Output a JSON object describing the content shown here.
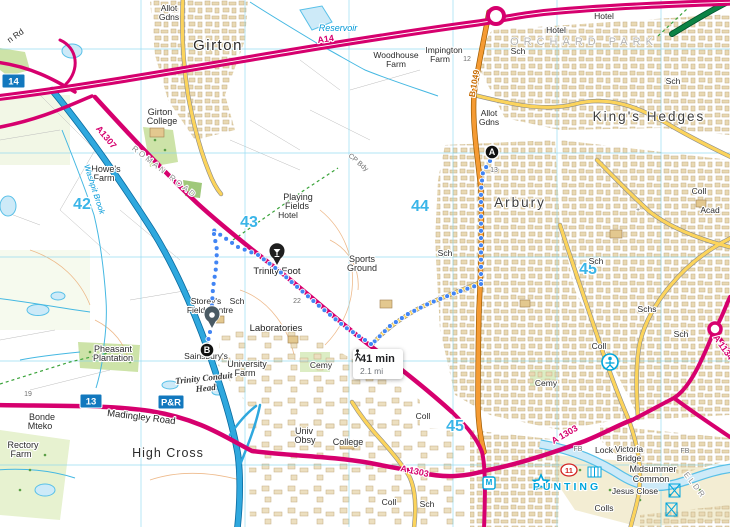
{
  "map": {
    "region": "Cambridge north-west: Girton, Arbury, King's Hedges, High Cross",
    "tooltip": {
      "duration": "41 min",
      "distance": "2.1 mi",
      "mode": "walking"
    },
    "colors": {
      "route_dot": "#4285f4",
      "motorway": "#2fa8de",
      "a_road": "#d6006e",
      "b_road": "#f59b33",
      "primary_green": "#0c8345",
      "minor_road": "#fcd45c",
      "water": "#cdeaf8",
      "grid": "#7fd4f0",
      "urban": "#e9d9b4"
    },
    "route": {
      "segments": [
        [
          [
            490,
            161
          ],
          [
            483,
            172
          ],
          [
            481,
            190
          ],
          [
            481,
            220
          ],
          [
            481,
            250
          ],
          [
            481,
            282
          ]
        ],
        [
          [
            481,
            284
          ],
          [
            455,
            293
          ],
          [
            430,
            303
          ],
          [
            408,
            314
          ],
          [
            390,
            326
          ],
          [
            373,
            343
          ]
        ],
        [
          [
            371,
            344
          ],
          [
            345,
            327
          ],
          [
            318,
            305
          ],
          [
            295,
            285
          ],
          [
            278,
            270
          ],
          [
            258,
            255
          ],
          [
            238,
            247
          ],
          [
            222,
            236
          ],
          [
            212,
            229
          ]
        ],
        [
          [
            214,
            234
          ],
          [
            217,
            250
          ],
          [
            216,
            268
          ],
          [
            213,
            288
          ],
          [
            212,
            305
          ],
          [
            211,
            316
          ]
        ],
        [
          [
            210,
            332
          ],
          [
            208,
            341
          ],
          [
            207,
            347
          ]
        ]
      ],
      "markers": [
        {
          "label": "A",
          "x": 492,
          "y": 152
        },
        {
          "label": "B",
          "x": 207,
          "y": 350
        }
      ],
      "pins": [
        {
          "name": "trinity-foot-pin",
          "x": 277,
          "y": 266,
          "color": "#1f1f1f",
          "glyph": "glass"
        },
        {
          "name": "storey-field-centre-pin",
          "x": 212,
          "y": 329,
          "color": "#4a5a63",
          "glyph": "dot"
        }
      ]
    },
    "badges": [
      {
        "t": "14",
        "x": 2,
        "y": 74,
        "w": 23,
        "h": 14,
        "type": "motorway-junction"
      },
      {
        "t": "13",
        "x": 80,
        "y": 394,
        "w": 22,
        "h": 14,
        "type": "motorway-junction"
      },
      {
        "t": "P&R",
        "x": 158,
        "y": 395,
        "w": 26,
        "h": 14,
        "type": "park-and-ride"
      }
    ],
    "labels": [
      {
        "t": "Girton",
        "x": 218,
        "y": 50,
        "cls": "big"
      },
      {
        "t": "n Rd",
        "x": 17,
        "y": 38,
        "cls": "sm",
        "r": -35
      },
      {
        "t": "Allot",
        "x": 169,
        "y": 11,
        "cls": "sm"
      },
      {
        "t": "Gdns",
        "x": 169,
        "y": 20,
        "cls": "sm"
      },
      {
        "t": "Reservoir",
        "x": 338,
        "y": 31,
        "cls": "water"
      },
      {
        "t": "A14",
        "x": 326,
        "y": 42,
        "cls": "rpink",
        "r": -8
      },
      {
        "t": "Woodhouse",
        "x": 396,
        "y": 58,
        "cls": "sm"
      },
      {
        "t": "Farm",
        "x": 396,
        "y": 67,
        "cls": "sm"
      },
      {
        "t": "Impington",
        "x": 444,
        "y": 53,
        "cls": "sm"
      },
      {
        "t": "Farm",
        "x": 440,
        "y": 62,
        "cls": "sm"
      },
      {
        "t": "12",
        "x": 467,
        "y": 61,
        "cls": "tiny"
      },
      {
        "t": "B 1049",
        "x": 477,
        "y": 84,
        "cls": "rorange",
        "r": -80
      },
      {
        "t": "Hotel",
        "x": 604,
        "y": 19,
        "cls": "sm"
      },
      {
        "t": "Hotel",
        "x": 556,
        "y": 33,
        "cls": "sm"
      },
      {
        "t": "ORCHARD PARK",
        "x": 584,
        "y": 45,
        "cls": "faint"
      },
      {
        "t": "Sch",
        "x": 518,
        "y": 54,
        "cls": "sm"
      },
      {
        "t": "Sch",
        "x": 673,
        "y": 84,
        "cls": "sm"
      },
      {
        "t": "King's Hedges",
        "x": 649,
        "y": 121,
        "cls": "big2"
      },
      {
        "t": "Allot",
        "x": 489,
        "y": 116,
        "cls": "sm"
      },
      {
        "t": "Gdns",
        "x": 489,
        "y": 125,
        "cls": "sm"
      },
      {
        "t": "Girton",
        "x": 160,
        "y": 115,
        "cls": "sm2"
      },
      {
        "t": "College",
        "x": 162,
        "y": 124,
        "cls": "sm2"
      },
      {
        "t": "A1307",
        "x": 104,
        "y": 139,
        "cls": "rpink",
        "r": 50
      },
      {
        "t": "ROMAN ROAD",
        "x": 163,
        "y": 174,
        "cls": "caps",
        "r": 38
      },
      {
        "t": "Howe's",
        "x": 106,
        "y": 172,
        "cls": "sm2"
      },
      {
        "t": "Farm",
        "x": 104,
        "y": 181,
        "cls": "sm2"
      },
      {
        "t": "Washpit Brook",
        "x": 92,
        "y": 190,
        "cls": "water2",
        "r": 72
      },
      {
        "t": "42",
        "x": 82,
        "y": 209,
        "cls": "grid"
      },
      {
        "t": "43",
        "x": 249,
        "y": 227,
        "cls": "grid"
      },
      {
        "t": "44",
        "x": 420,
        "y": 211,
        "cls": "grid"
      },
      {
        "t": "45",
        "x": 588,
        "y": 274,
        "cls": "grid"
      },
      {
        "t": "45",
        "x": 455,
        "y": 431,
        "cls": "grid"
      },
      {
        "t": "Playing",
        "x": 298,
        "y": 200,
        "cls": "sm2"
      },
      {
        "t": "Fields",
        "x": 297,
        "y": 209,
        "cls": "sm2"
      },
      {
        "t": "Hotel",
        "x": 288,
        "y": 218,
        "cls": "sm"
      },
      {
        "t": "CP Bdy",
        "x": 357,
        "y": 164,
        "cls": "tiny",
        "r": 40
      },
      {
        "t": "Arbury",
        "x": 520,
        "y": 207,
        "cls": "big2"
      },
      {
        "t": "13",
        "x": 494,
        "y": 172,
        "cls": "tiny"
      },
      {
        "t": "Sports",
        "x": 362,
        "y": 262,
        "cls": "sm2"
      },
      {
        "t": "Ground",
        "x": 362,
        "y": 271,
        "cls": "sm2"
      },
      {
        "t": "Trinity Foot",
        "x": 277,
        "y": 274,
        "cls": "sm3"
      },
      {
        "t": "Sch",
        "x": 445,
        "y": 256,
        "cls": "sm"
      },
      {
        "t": "Sch",
        "x": 596,
        "y": 264,
        "cls": "sm"
      },
      {
        "t": "Coll",
        "x": 699,
        "y": 194,
        "cls": "sm"
      },
      {
        "t": "Acad",
        "x": 710,
        "y": 213,
        "cls": "sm"
      },
      {
        "t": "Schs",
        "x": 647,
        "y": 312,
        "cls": "sm"
      },
      {
        "t": "Coll",
        "x": 599,
        "y": 349,
        "cls": "sm"
      },
      {
        "t": "Sch",
        "x": 681,
        "y": 337,
        "cls": "sm"
      },
      {
        "t": "+",
        "x": 638,
        "y": 212,
        "cls": "tiny"
      },
      {
        "t": "22",
        "x": 297,
        "y": 303,
        "cls": "tiny"
      },
      {
        "t": "Storey's",
        "x": 206,
        "y": 304,
        "cls": "sm"
      },
      {
        "t": "Sch",
        "x": 237,
        "y": 304,
        "cls": "sm"
      },
      {
        "t": "Field Centre",
        "x": 210,
        "y": 313,
        "cls": "sm"
      },
      {
        "t": "Laboratories",
        "x": 276,
        "y": 331,
        "cls": "sm3"
      },
      {
        "t": "Sainsbury's",
        "x": 206,
        "y": 359,
        "cls": "sm"
      },
      {
        "t": "University",
        "x": 247,
        "y": 367,
        "cls": "sm2"
      },
      {
        "t": "Farm",
        "x": 245,
        "y": 376,
        "cls": "sm2"
      },
      {
        "t": "Cemy",
        "x": 321,
        "y": 368,
        "cls": "sm"
      },
      {
        "t": "Cemy",
        "x": 546,
        "y": 386,
        "cls": "sm"
      },
      {
        "t": "Pheasant",
        "x": 113,
        "y": 352,
        "cls": "sm2"
      },
      {
        "t": "Plantation",
        "x": 113,
        "y": 361,
        "cls": "sm2"
      },
      {
        "t": "Trinity Conduit",
        "x": 204,
        "y": 381,
        "cls": "goth",
        "r": -6
      },
      {
        "t": "Head",
        "x": 206,
        "y": 391,
        "cls": "goth",
        "r": -6
      },
      {
        "t": "19",
        "x": 28,
        "y": 396,
        "cls": "tiny"
      },
      {
        "t": "Madingley Road",
        "x": 141,
        "y": 420,
        "cls": "sm3",
        "r": 7
      },
      {
        "t": "Bonde",
        "x": 42,
        "y": 420,
        "cls": "sm2"
      },
      {
        "t": "Mteko",
        "x": 40,
        "y": 429,
        "cls": "sm2"
      },
      {
        "t": "Rectory",
        "x": 23,
        "y": 448,
        "cls": "sm2"
      },
      {
        "t": "Farm",
        "x": 21,
        "y": 457,
        "cls": "sm2"
      },
      {
        "t": "High Cross",
        "x": 168,
        "y": 457,
        "cls": "med"
      },
      {
        "t": "Univ",
        "x": 304,
        "y": 434,
        "cls": "sm2"
      },
      {
        "t": "Obsy",
        "x": 305,
        "y": 443,
        "cls": "sm2"
      },
      {
        "t": "College",
        "x": 348,
        "y": 445,
        "cls": "sm2"
      },
      {
        "t": "A 1303",
        "x": 414,
        "y": 474,
        "cls": "rpink",
        "r": 12
      },
      {
        "t": "A 1303",
        "x": 566,
        "y": 437,
        "cls": "rpink",
        "r": -30
      },
      {
        "t": "A 1134",
        "x": 721,
        "y": 349,
        "cls": "rpink",
        "r": 55
      },
      {
        "t": "Coll",
        "x": 423,
        "y": 419,
        "cls": "sm"
      },
      {
        "t": "Coll",
        "x": 389,
        "y": 505,
        "cls": "sm"
      },
      {
        "t": "Sch",
        "x": 427,
        "y": 507,
        "cls": "sm"
      },
      {
        "t": "Colls",
        "x": 604,
        "y": 511,
        "cls": "sm"
      },
      {
        "t": "FB",
        "x": 578,
        "y": 451,
        "cls": "tiny"
      },
      {
        "t": "FB",
        "x": 685,
        "y": 453,
        "cls": "tiny"
      },
      {
        "t": "Lock",
        "x": 604,
        "y": 453,
        "cls": "sm"
      },
      {
        "t": "Victoria",
        "x": 629,
        "y": 452,
        "cls": "sm"
      },
      {
        "t": "Bridge",
        "x": 629,
        "y": 461,
        "cls": "sm"
      },
      {
        "t": "Midsummer",
        "x": 653,
        "y": 472,
        "cls": "sm2"
      },
      {
        "t": "Common",
        "x": 651,
        "y": 482,
        "cls": "sm2"
      },
      {
        "t": "Jesus Close",
        "x": 635,
        "y": 494,
        "cls": "sm"
      },
      {
        "t": "PUNTING",
        "x": 567,
        "y": 490,
        "cls": "cyancaps"
      },
      {
        "t": "ELDR",
        "x": 693,
        "y": 487,
        "cls": "caps",
        "r": 52
      },
      {
        "t": "M",
        "x": 489,
        "y": 485,
        "cls": "micon"
      },
      {
        "t": "11",
        "x": 569,
        "y": 473,
        "cls": "cyc"
      }
    ],
    "grid": {
      "verticals": [
        141,
        245,
        349,
        453,
        557,
        661
      ],
      "horizontals": [
        49,
        153,
        257,
        361,
        465
      ]
    }
  }
}
